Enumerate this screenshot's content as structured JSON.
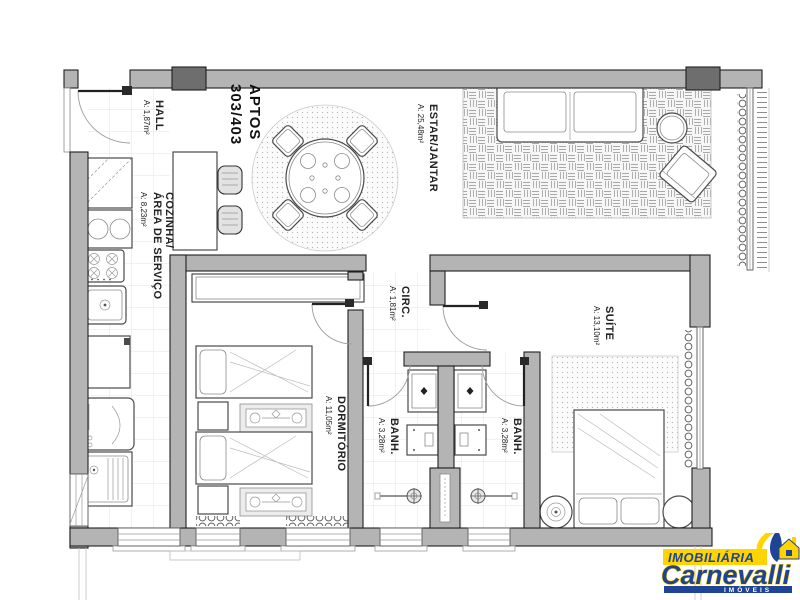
{
  "title": {
    "name": "APTOS",
    "number": "303/403"
  },
  "rooms": {
    "hall": {
      "name": "HALL",
      "area": "A: 1,87m²"
    },
    "cozinha": {
      "line1": "COZINHA/",
      "line2": "ÁREA DE SERVIÇO",
      "area": "A: 8,23m²"
    },
    "estar": {
      "name": "ESTAR/JANTAR",
      "area": "A: 25,48m²"
    },
    "circ": {
      "name": "CIRC.",
      "area": "A: 1,81m²"
    },
    "suite": {
      "name": "SUÍTE",
      "area": "A: 13,10m²"
    },
    "dormitorio": {
      "name": "DORMITÓRIO",
      "area": "A: 11,05m²"
    },
    "banh_esq": {
      "name": "BANH.",
      "area": "A: 3,28m²"
    },
    "banh_dir": {
      "name": "BANH.",
      "area": "A: 3,28m²"
    }
  },
  "logo": {
    "top": "IMOBILIÁRIA",
    "name": "Carnevalli",
    "tagline": "IMÓVEIS"
  },
  "colors": {
    "wall": "#b4b4b4",
    "column": "#6e6e6e",
    "line": "#1f1f1f",
    "logo_yellow": "#ffd400",
    "logo_blue": "#1f4496"
  }
}
